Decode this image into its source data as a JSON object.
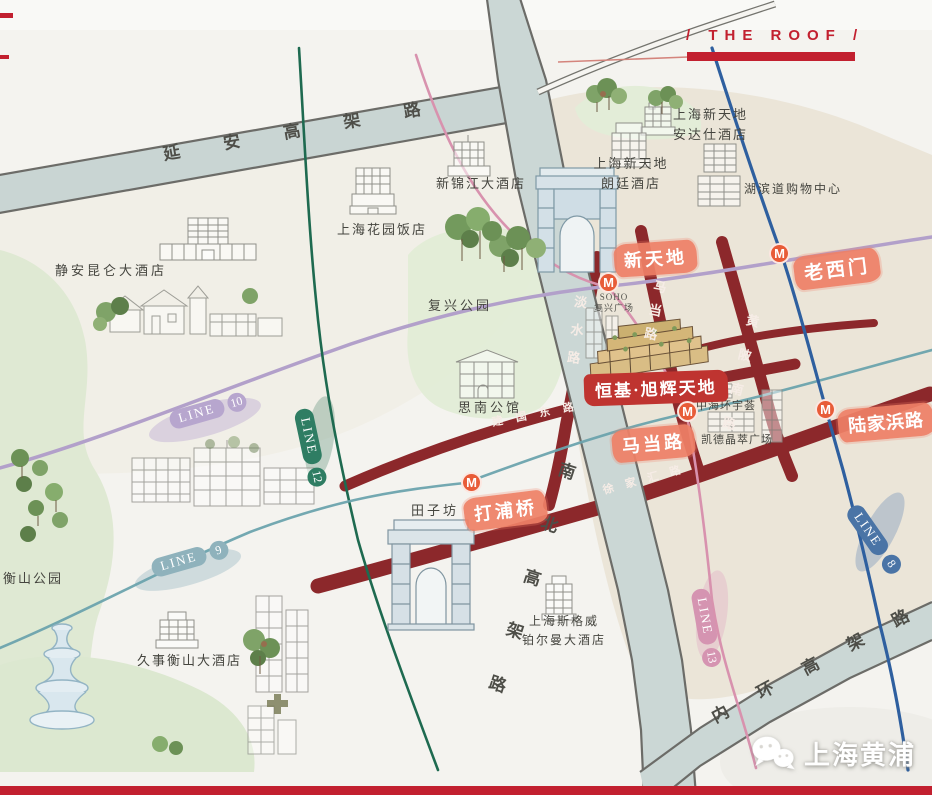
{
  "title": {
    "roof": "/ THE ROOF /"
  },
  "roads": {
    "yanan_elevated": "延安高架路",
    "north_south_elevated": "南北高架路",
    "inner_ring_elevated": "内环高架路",
    "xujiahui_road": "徐家汇路",
    "jianguo_east_road": "建国东路",
    "danshui_road": "淡水路",
    "madang_road": "马当路",
    "huangpi_south_road": "黄陂南路"
  },
  "metro": {
    "m": "M",
    "lines": [
      {
        "name": "LINE",
        "number": "10",
        "color": "#b7a6ce"
      },
      {
        "name": "LINE",
        "number": "12",
        "color": "#2f7d63"
      },
      {
        "name": "LINE",
        "number": "9",
        "color": "#8fb2bc"
      },
      {
        "name": "LINE",
        "number": "13",
        "color": "#d594b1"
      },
      {
        "name": "LINE",
        "number": "8",
        "color": "#4a74a6"
      }
    ],
    "stations": [
      {
        "name": "新天地"
      },
      {
        "name": "老西门"
      },
      {
        "name": "马当路"
      },
      {
        "name": "陆家浜路"
      },
      {
        "name": "打浦桥"
      }
    ]
  },
  "project": {
    "name": "恒基·旭辉天地"
  },
  "places": {
    "jingan_kunlun_hotel": "静安昆仑大酒店",
    "xinjinjiang_hotel": "新锦江大酒店",
    "garden_hotel": "上海花园饭店",
    "andaz_line1": "上海新天地",
    "andaz_line2": "安达仕酒店",
    "langham_line1": "上海新天地",
    "langham_line2": "朗廷酒店",
    "hubindao_mall": "湖滨道购物中心",
    "fuxing_park": "复兴公园",
    "soho_line1": "SOHO",
    "soho_line2": "复兴广场",
    "sinan_mansions": "思南公馆",
    "zhonghai_huanyuhui": "中海环宇荟",
    "capitaland_lux": "凯德晶萃广场",
    "tianzifang": "田子坊",
    "hengshan_park": "衡山公园",
    "jiushi_hengshan_hotel": "久事衡山大酒店",
    "pullman_line1": "上海斯格威",
    "pullman_line2": "铂尔曼大酒店"
  },
  "watermark": {
    "name": "上海黄浦"
  },
  "colors": {
    "accent_red": "#c2202f",
    "road_dark_red": "#8c282b",
    "badge_coral": "#ee8066",
    "metro_m_orange": "#e85c38",
    "line10_purple": "#b2a0ca",
    "line12_green": "#1e6a50",
    "line9_teal": "#6ba3ad",
    "line13_pink": "#d892ae",
    "line8_blue": "#2e5f9f",
    "elevated_road_fill": "#cbd7d5"
  }
}
